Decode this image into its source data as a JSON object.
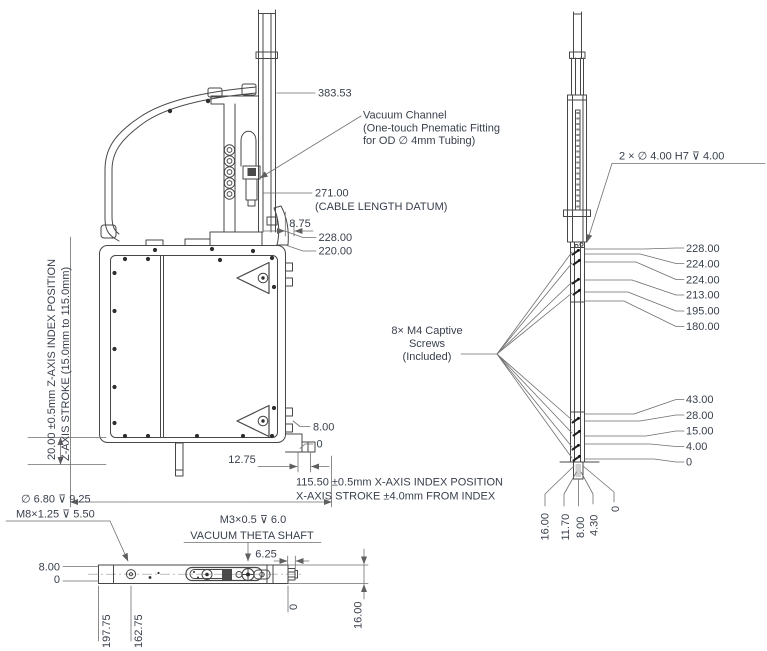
{
  "colors": {
    "line": "#474747",
    "dim": "#6f6f6f",
    "text": "#39404c",
    "background": "#ffffff"
  },
  "front_view": {
    "dim_383": "383.53",
    "vacuum_note": {
      "l1": "Vacuum Channel",
      "l2": "(One-touch Pnematic Fitting",
      "l3": "for OD ∅ 4mm Tubing)"
    },
    "dim_271": "271.00",
    "cable_datum_note": "(CABLE LENGTH DATUM)",
    "dim_8_75": "8.75",
    "dim_228": "228.00",
    "dim_220": "220.00",
    "z_note": {
      "l1": "20.00 ±0.5mm Z-AXIS INDEX POSITION",
      "l2": "Z-AXIS STROKE (15.0mm to 115.0mm)"
    },
    "dim_8": "8.00",
    "dim_0": "0",
    "dim_12_75": "12.75",
    "x_note": {
      "l1": "115.50 ±0.5mm X-AXIS INDEX POSITION",
      "l2": "X-AXIS STROKE ±4.0mm FROM INDEX"
    }
  },
  "side_view": {
    "dowel_note": "2 × ∅ 4.00 H7 ⊽ 4.00",
    "screws_note": {
      "l1": "8× M4 Captive",
      "l2": "Screws",
      "l3": "(Included)"
    },
    "dims_upper": [
      "228.00",
      "224.00",
      "224.00",
      "213.00",
      "195.00",
      "180.00"
    ],
    "dims_lower": [
      "43.00",
      "28.00",
      "15.00",
      "4.00",
      "0"
    ],
    "dims_base": [
      "16.00",
      "11.70",
      "8.00",
      "4.30",
      "0"
    ]
  },
  "bottom_view": {
    "counterbore_note": "∅ 6.80 ⊽ 9.25",
    "thread_note": "M8×1.25 ⊽ 5.50",
    "dim_8": "8.00",
    "dim_0": "0",
    "shaft_thread_note": "M3×0.5 ⊽ 6.0",
    "shaft_label": "VACUUM THETA SHAFT",
    "dim_6_25": "6.25",
    "dim_16": "16.00",
    "dims_length": [
      "197.75",
      "162.75",
      "0"
    ]
  }
}
